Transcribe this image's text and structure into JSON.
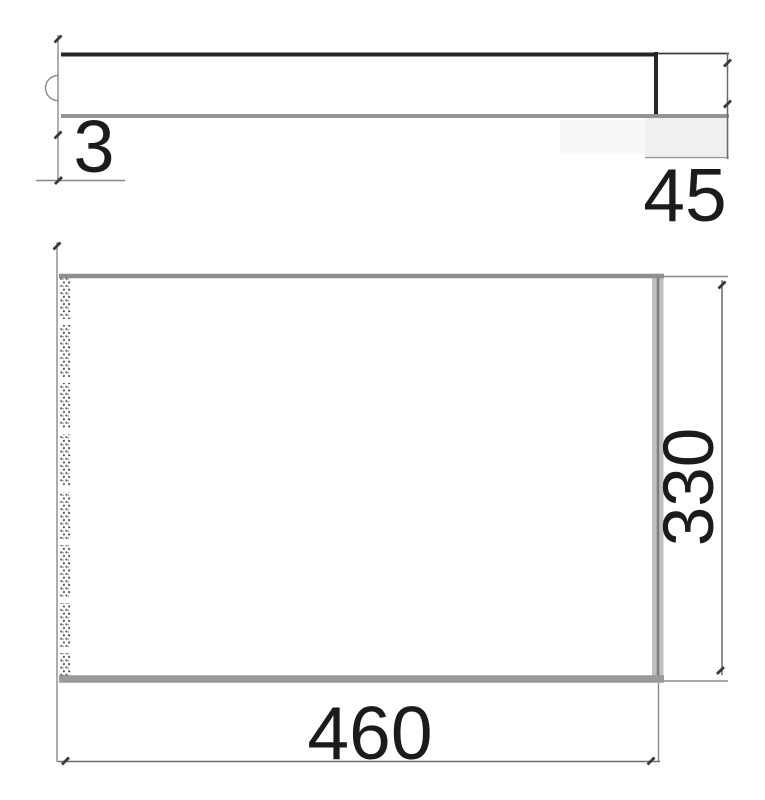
{
  "colors": {
    "background": "#ffffff",
    "text": "#1b1b1b",
    "outline_dark": "#262626",
    "outline_gray": "#949494"
  },
  "side_view": {
    "thickness_dim": "3",
    "end_height_dim": "45"
  },
  "plan_view": {
    "width_dim": "460",
    "depth_dim": "330"
  }
}
